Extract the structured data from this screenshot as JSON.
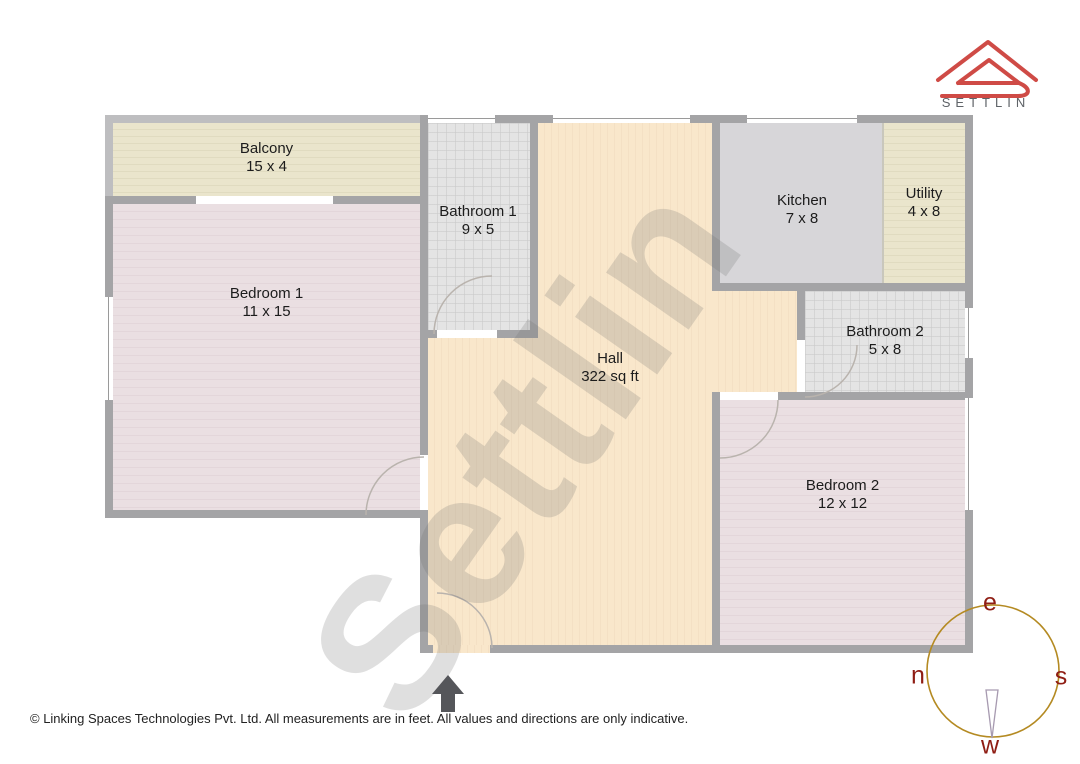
{
  "brand": {
    "name": "SETTLIN",
    "logo": "roof-outline-icon",
    "logo_color": "#cf4b46",
    "text_color": "#5f6368"
  },
  "watermark": "Settlin",
  "rooms": [
    {
      "id": "balcony",
      "name": "Balcony",
      "dims": "15 x 4"
    },
    {
      "id": "bedroom-1",
      "name": "Bedroom 1",
      "dims": "11 x 15"
    },
    {
      "id": "bathroom-1",
      "name": "Bathroom 1",
      "dims": "9 x 5"
    },
    {
      "id": "hall",
      "name": "Hall",
      "dims": "322 sq ft"
    },
    {
      "id": "kitchen",
      "name": "Kitchen",
      "dims": "7 x 8"
    },
    {
      "id": "utility",
      "name": "Utility",
      "dims": "4 x 8"
    },
    {
      "id": "bathroom-2",
      "name": "Bathroom 2",
      "dims": "5 x 8"
    },
    {
      "id": "bedroom-2",
      "name": "Bedroom 2",
      "dims": "12 x 12"
    }
  ],
  "compass": {
    "top": "e",
    "right": "s",
    "bottom": "w",
    "left": "n",
    "ring_color": "#b48a22",
    "letter_color": "#8f1d14"
  },
  "entrance": {
    "symbol": "up-arrow",
    "color": "#55565a"
  },
  "footer": {
    "text": "© Linking Spaces Technologies Pvt. Ltd. All measurements are in feet. All values and directions are only indicative."
  },
  "palette": {
    "wall": "#a4a4a6",
    "balcony_wall": "#bebec0",
    "hall_floor": "#f9e7cb",
    "bedroom_floor": "#eadfe2",
    "bathroom_floor": "#e4e4e4",
    "kitchen_floor": "#d7d6d9",
    "balcony_floor": "#eae5cc"
  }
}
